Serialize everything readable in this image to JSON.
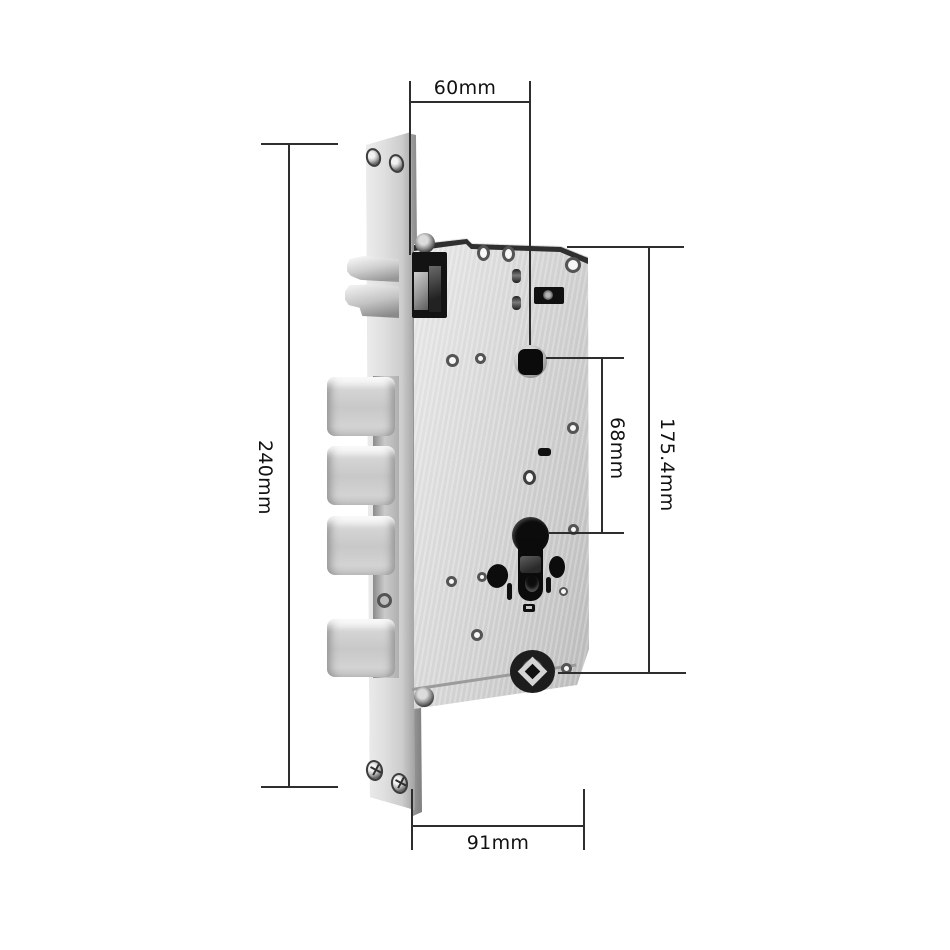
{
  "figure": {
    "type": "product-dimension-diagram",
    "subject": "mortise-lock-body"
  },
  "dimensions": {
    "backset_top": "60mm",
    "faceplate_height": "240mm",
    "spindle_to_cylinder": "68mm",
    "case_height": "175.4mm",
    "case_width_bottom": "91mm"
  },
  "colors": {
    "background": "#ffffff",
    "dimension_line": "#2e2e2e",
    "label_text": "#111111",
    "steel_light": "#efefef",
    "steel_mid": "#cdcdcd",
    "steel_dark": "#8f8f8f",
    "hole_black": "#0d0d0d"
  }
}
